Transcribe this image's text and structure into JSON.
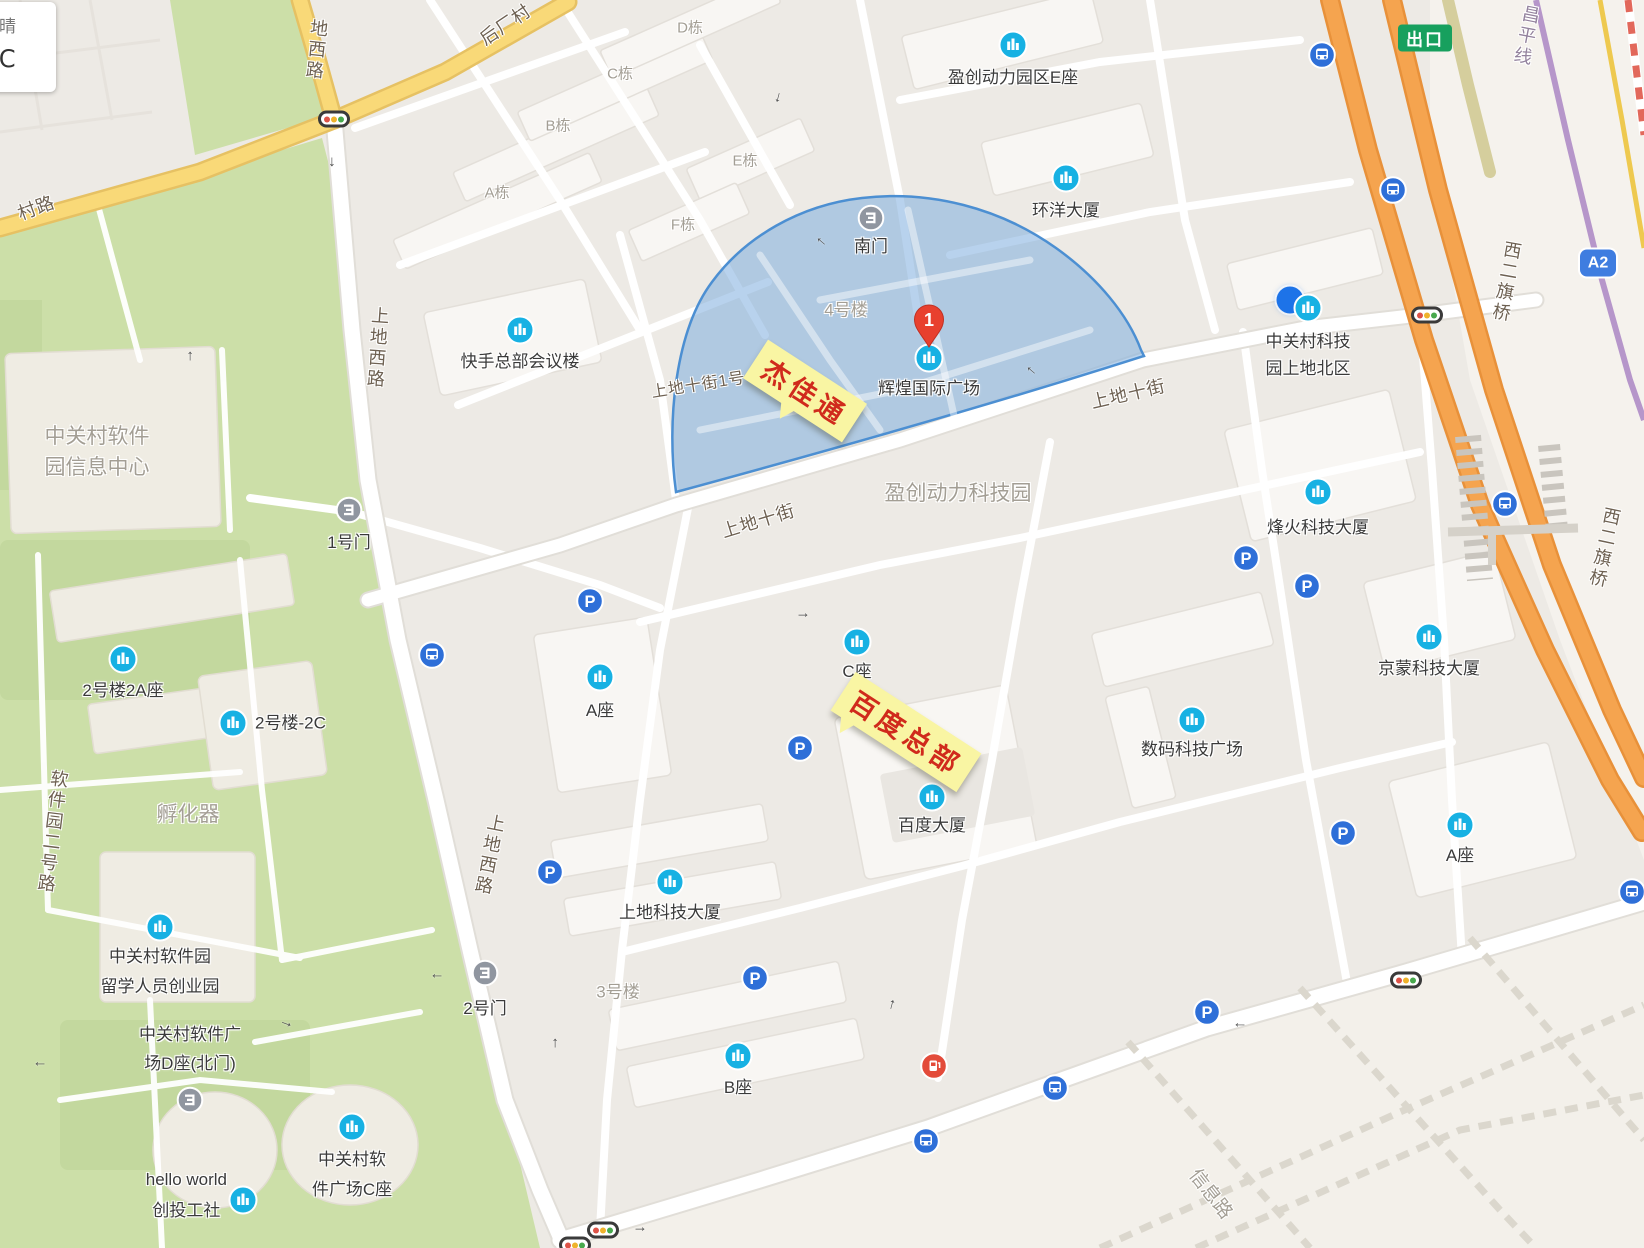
{
  "weather": {
    "condition": "晴",
    "temperature": "36℃"
  },
  "badges": {
    "exit": {
      "label": "出口",
      "x": 1425,
      "y": 38,
      "color": "#17a05e"
    },
    "highway_exit": {
      "label": "A2",
      "x": 1598,
      "y": 263,
      "color": "#3f7de0"
    }
  },
  "marker": {
    "number": "1",
    "x": 929,
    "tip_y": 354
  },
  "location_dot": {
    "x": 1290,
    "y": 300
  },
  "callouts": [
    {
      "text": "杰佳通",
      "x": 805,
      "y": 391,
      "rotate": 33,
      "tail": "center"
    },
    {
      "text": "百度总部",
      "x": 906,
      "y": 732,
      "rotate": 33,
      "tail": "left"
    }
  ],
  "pois": {
    "buildings": [
      {
        "x": 1013,
        "y": 45,
        "lines": [
          "盈创动力园区E座"
        ],
        "dy": 32
      },
      {
        "x": 1066,
        "y": 178,
        "lines": [
          "环洋大厦"
        ],
        "dy": 32
      },
      {
        "x": 520,
        "y": 330,
        "lines": [
          "快手总部会议楼"
        ],
        "dy": 31
      },
      {
        "x": 929,
        "y": 358,
        "lines": [
          "辉煌国际广场"
        ],
        "dy": 30
      },
      {
        "x": 1308,
        "y": 308,
        "lines": [
          "中关村科技",
          "园上地北区"
        ],
        "dy": 33,
        "lh": 27
      },
      {
        "x": 1318,
        "y": 492,
        "lines": [
          "烽火科技大厦"
        ],
        "dy": 35
      },
      {
        "x": 1429,
        "y": 637,
        "lines": [
          "京蒙科技大厦"
        ],
        "dy": 31
      },
      {
        "x": 123,
        "y": 659,
        "lines": [
          "2号楼2A座"
        ],
        "dy": 31
      },
      {
        "x": 233,
        "y": 723,
        "lines": [
          "2号楼-2C"
        ],
        "side": "right",
        "dx": 22
      },
      {
        "x": 857,
        "y": 642,
        "lines": [
          "C座"
        ],
        "dy": 29
      },
      {
        "x": 600,
        "y": 677,
        "lines": [
          "A座"
        ],
        "dy": 33
      },
      {
        "x": 932,
        "y": 797,
        "lines": [
          "百度大厦"
        ],
        "dy": 28
      },
      {
        "x": 670,
        "y": 882,
        "lines": [
          "上地科技大厦"
        ],
        "dy": 30
      },
      {
        "x": 1192,
        "y": 720,
        "lines": [
          "数码科技广场"
        ],
        "dy": 29
      },
      {
        "x": 738,
        "y": 1056,
        "lines": [
          "B座"
        ],
        "dy": 31
      },
      {
        "x": 160,
        "y": 927,
        "lines": [
          "中关村软件园",
          "留学人员创业园"
        ],
        "dy": 28,
        "lh": 30
      },
      {
        "x": 352,
        "y": 1127,
        "lines": [
          "中关村软",
          "件广场C座"
        ],
        "dy": 31,
        "lh": 30
      },
      {
        "x": 243,
        "y": 1200,
        "lines": [
          "hello world",
          "创投工社"
        ],
        "side": "left",
        "dx": -16,
        "lh": 31
      },
      {
        "x": 1460,
        "y": 825,
        "lines": [
          "A座"
        ],
        "dy": 30
      }
    ],
    "gates": [
      {
        "x": 871,
        "y": 218,
        "lines": [
          "南门"
        ],
        "dy": 28
      },
      {
        "x": 349,
        "y": 510,
        "lines": [
          "1号门"
        ],
        "dy": 32
      },
      {
        "x": 485,
        "y": 973,
        "lines": [
          "2号门"
        ],
        "dy": 35
      },
      {
        "x": 190,
        "y": 1100,
        "lines": [
          "中关村软件广",
          "场D座(北门)"
        ],
        "side": "above",
        "lh": 29
      }
    ],
    "parking": [
      {
        "x": 590,
        "y": 601
      },
      {
        "x": 800,
        "y": 748
      },
      {
        "x": 1307,
        "y": 586
      },
      {
        "x": 550,
        "y": 872
      },
      {
        "x": 755,
        "y": 978
      },
      {
        "x": 1343,
        "y": 833
      },
      {
        "x": 1207,
        "y": 1012
      },
      {
        "x": 1246,
        "y": 558
      }
    ],
    "bus": [
      {
        "x": 1322,
        "y": 55
      },
      {
        "x": 1393,
        "y": 190
      },
      {
        "x": 1505,
        "y": 504
      },
      {
        "x": 432,
        "y": 655
      },
      {
        "x": 926,
        "y": 1141
      },
      {
        "x": 1055,
        "y": 1088
      },
      {
        "x": 1632,
        "y": 892
      }
    ],
    "stations": [
      {
        "x": 934,
        "y": 1066
      }
    ],
    "traffic_lights": [
      {
        "x": 334,
        "y": 119
      },
      {
        "x": 1427,
        "y": 315
      },
      {
        "x": 1406,
        "y": 980
      },
      {
        "x": 603,
        "y": 1230
      },
      {
        "x": 575,
        "y": 1245
      }
    ]
  },
  "labels": {
    "area": [
      {
        "lines": [
          "中关村软件",
          "园信息中心"
        ],
        "x": 97,
        "y": 452,
        "size": 21,
        "lh": 31
      },
      {
        "lines": [
          "孵化器"
        ],
        "x": 188,
        "y": 813,
        "size": 21
      },
      {
        "lines": [
          "盈创动力科技园"
        ],
        "x": 958,
        "y": 492,
        "size": 21
      },
      {
        "lines": [
          "3号楼"
        ],
        "x": 618,
        "y": 990,
        "size": 17
      },
      {
        "lines": [
          "4号楼"
        ],
        "x": 846,
        "y": 308,
        "size": 17
      },
      {
        "lines": [
          "信息路"
        ],
        "x": 1212,
        "y": 1193,
        "size": 19,
        "rotate": 52
      },
      {
        "lines": [
          "A栋"
        ],
        "x": 497,
        "y": 192,
        "size": 15
      },
      {
        "lines": [
          "B栋"
        ],
        "x": 558,
        "y": 125,
        "size": 15
      },
      {
        "lines": [
          "C栋"
        ],
        "x": 620,
        "y": 73,
        "size": 15
      },
      {
        "lines": [
          "D栋"
        ],
        "x": 690,
        "y": 27,
        "size": 15
      },
      {
        "lines": [
          "E栋"
        ],
        "x": 745,
        "y": 160,
        "size": 15
      },
      {
        "lines": [
          "F栋"
        ],
        "x": 683,
        "y": 224,
        "size": 15
      }
    ],
    "road": [
      {
        "text": "后厂村",
        "x": 505,
        "y": 24,
        "rotate": -34
      },
      {
        "text": "村路",
        "x": 36,
        "y": 207,
        "rotate": -20
      },
      {
        "text": "地西路",
        "x": 316,
        "y": 50,
        "vertical": true,
        "rotate": 6
      },
      {
        "text": "上地西路",
        "x": 377,
        "y": 348,
        "vertical": true,
        "rotate": 4
      },
      {
        "text": "上地西路",
        "x": 489,
        "y": 855,
        "vertical": true,
        "rotate": 11
      },
      {
        "text": "软件园二号路",
        "x": 52,
        "y": 832,
        "vertical": true,
        "rotate": 7
      },
      {
        "text": "上地十街",
        "x": 758,
        "y": 520,
        "rotate": -17
      },
      {
        "text": "上地十街",
        "x": 1128,
        "y": 393,
        "rotate": -13
      },
      {
        "text": "上地十街1号",
        "x": 698,
        "y": 383,
        "rotate": -9,
        "size": 16
      },
      {
        "text": "昌平线",
        "x": 1526,
        "y": 36,
        "vertical": true,
        "rotate": 11,
        "color": "#93829d"
      },
      {
        "text": "西二旗桥",
        "x": 1506,
        "y": 282,
        "vertical": true,
        "rotate": 10
      },
      {
        "text": "西二旗桥",
        "x": 1604,
        "y": 548,
        "vertical": true,
        "rotate": 12
      }
    ]
  },
  "arrows": [
    {
      "x": 334,
      "y": 162,
      "r": 90
    },
    {
      "x": 188,
      "y": 356,
      "r": -90
    },
    {
      "x": 780,
      "y": 98,
      "r": 105
    },
    {
      "x": 820,
      "y": 243,
      "r": -140
    },
    {
      "x": 1030,
      "y": 372,
      "r": -140
    },
    {
      "x": 803,
      "y": 613,
      "r": 0
    },
    {
      "x": 553,
      "y": 1043,
      "r": -90
    },
    {
      "x": 437,
      "y": 978,
      "r": 180
    },
    {
      "x": 40,
      "y": 1066,
      "r": 180
    },
    {
      "x": 287,
      "y": 1022,
      "r": 20
    },
    {
      "x": 890,
      "y": 1004,
      "r": -75
    },
    {
      "x": 1240,
      "y": 1027,
      "r": 180
    },
    {
      "x": 640,
      "y": 1227,
      "r": 0
    }
  ],
  "icons": {
    "parking_letter": "P",
    "arrow_glyph": "→"
  },
  "colors": {
    "poi": "#17b1e3",
    "transit": "#2e6fd8",
    "gate": "#9096a0",
    "station": "#e34b3a",
    "marker": "#e8402e",
    "highlight_fill": "rgba(125,173,222,0.55)",
    "highlight_stroke": "#4c8fd2",
    "callout_bg": "#f9f5a3",
    "callout_text": "#d02a1c",
    "expressway": "#f5a44f",
    "major_road": "#f9d978",
    "park": "#ccdfa8",
    "subway_line": "#b696ca"
  }
}
